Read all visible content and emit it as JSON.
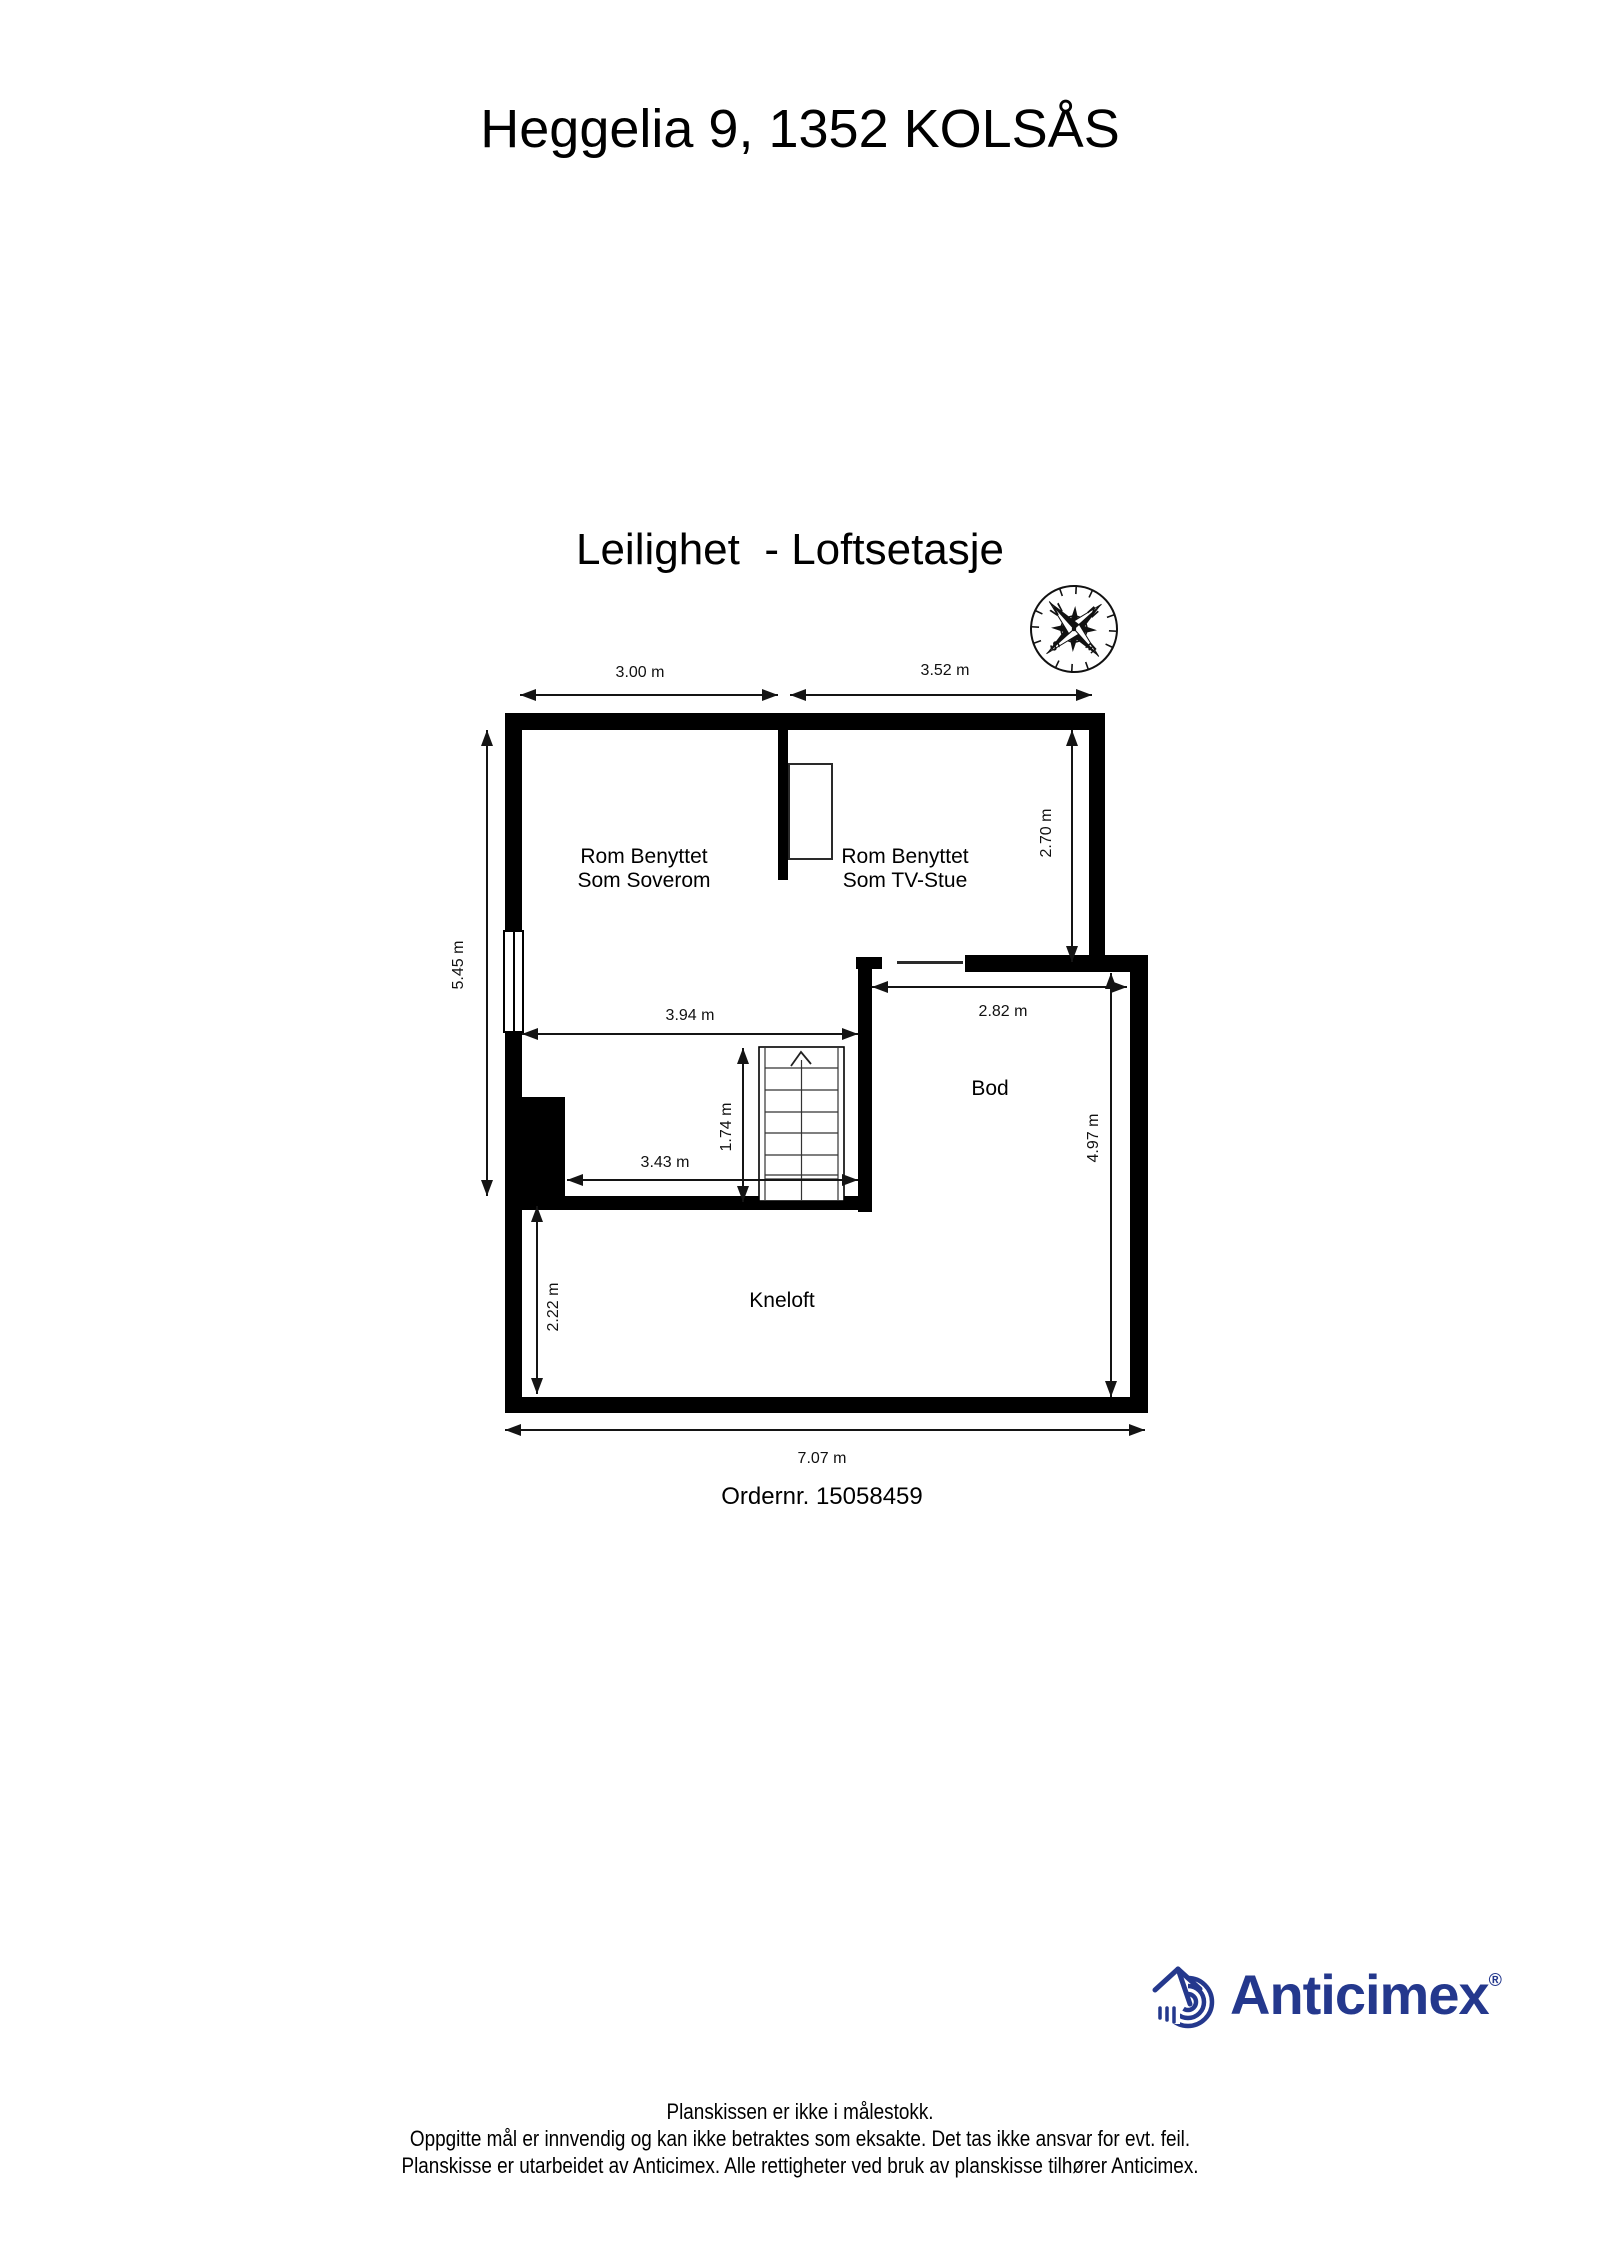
{
  "page": {
    "title": "Heggelia 9, 1352 KOLSÅS",
    "subtitle": "Leilighet  - Loftsetasje"
  },
  "plan": {
    "compass": {
      "n": "N",
      "e": "E",
      "s": "S",
      "w": "W"
    },
    "rooms": {
      "soverom": {
        "line1": "Rom Benyttet",
        "line2": "Som Soverom"
      },
      "tvstue": {
        "line1": "Rom Benyttet",
        "line2": "Som TV-Stue"
      },
      "bod": {
        "label": "Bod"
      },
      "kneloft": {
        "label": "Kneloft"
      }
    },
    "dimensions": {
      "w_soverom": "3.00 m",
      "w_tvstue": "3.52 m",
      "h_left": "5.45 m",
      "h_tvstue": "2.70 m",
      "w_inner": "3.94 m",
      "w_bod": "2.82 m",
      "h_stairs": "1.74 m",
      "w_stair_room": "3.43 m",
      "h_bod": "4.97 m",
      "h_kneloft": "2.22 m",
      "w_total": "7.07 m"
    },
    "order_number": "Ordernr. 15058459"
  },
  "branding": {
    "logo_text": "Anticimex",
    "registered": "®",
    "color": "#24388D"
  },
  "footer": {
    "line1": "Planskissen er ikke i målestokk.",
    "line2": "Oppgitte mål er innvendig og kan ikke betraktes som eksakte. Det tas ikke ansvar for evt. feil.",
    "line3": "Planskisse er utarbeidet av Anticimex. Alle rettigheter ved bruk av planskisse tilhører Anticimex."
  }
}
